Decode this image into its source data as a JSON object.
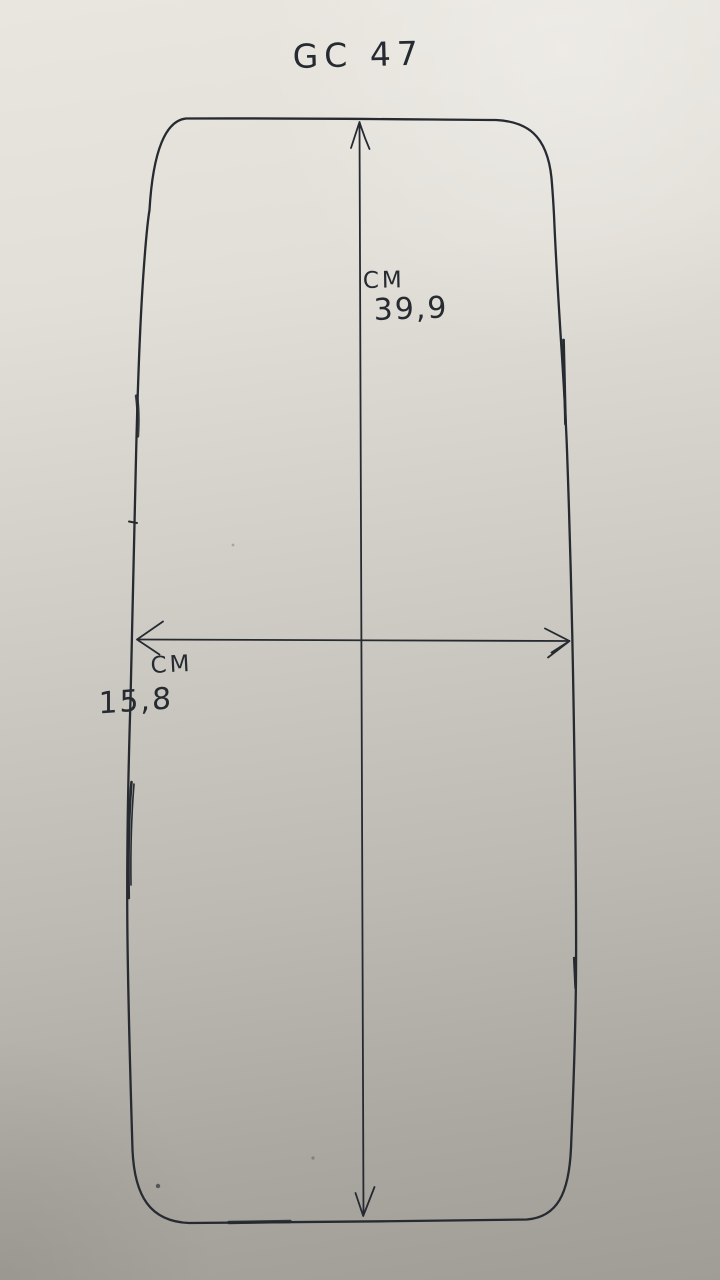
{
  "photo": {
    "title": "GC 47",
    "dimensions": {
      "vertical": {
        "unit": "CM",
        "value": "39,9"
      },
      "horizontal": {
        "unit": "CM",
        "value": "15,8"
      }
    }
  },
  "colors": {
    "ink": "#262a31",
    "paper_top": "#e9e6df",
    "paper_mid": "#cfccc5",
    "paper_bottom": "#a09d97"
  }
}
